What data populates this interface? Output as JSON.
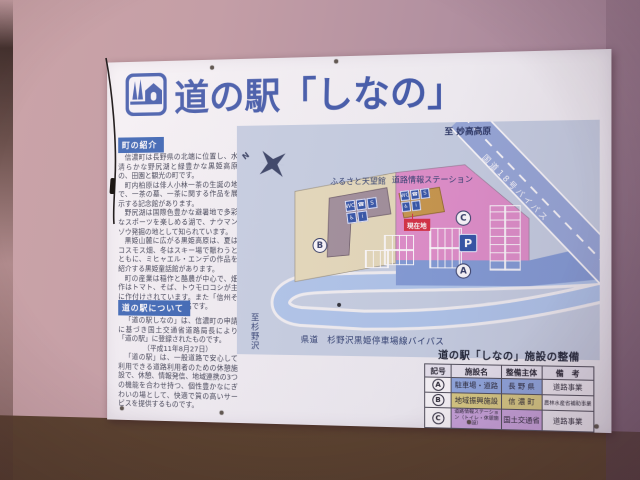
{
  "colors": {
    "accent_blue": "#3a57aa",
    "heading_bar_blue": "#2f5fb2",
    "map_bg": "#c5d0e3",
    "site_beige": "#e6dcba",
    "site_pink": "#e08cc9",
    "front_road_blue": "#7e9ad6",
    "bypass_road_blue": "#93a7d9",
    "loop_road_blue": "#adc6ec",
    "building_b": "#9e8d98",
    "building_c": "#c79544",
    "icon_blue": "#2a4fa5",
    "current_location_red": "#d5283c",
    "table_row_a": "#8ca7e0",
    "table_row_b": "#dacd7e",
    "table_row_c": "#c9a3de",
    "wall_pink": "#c29ca4",
    "wall_brown": "#6e4f3a"
  },
  "sign": {
    "title": "道の駅「しなの」",
    "logo": "michinoeki-pictogram",
    "sections": [
      {
        "heading": "町の紹介",
        "paragraphs": [
          "信濃町は長野県の北端に位置し、水清らかな野尻湖と緑豊かな黒姫高原の、田園と観光の町です。",
          "町内柏原は俳人小林一茶の生誕の地で、一茶の墓、一茶に関する作品を展示する記念館があります。",
          "野尻湖は国際色豊かな避暑地で多彩なスポーツを楽しめる湖で、ナウマンゾウ発掘の地として知られています。",
          "黒姫山麓に広がる黒姫高原は、夏はコスモス畑、冬はスキー場で賑わうとともに、ミヒャエル・エンデの作品を紹介する黒姫童話館があります。",
          "町の産業は稲作と酪農が中心で、畑作はトマト、そば、トウモロコシが主に作付けされています。また「信州そば」の生産地として有名です。"
        ]
      },
      {
        "heading": "道の駅について",
        "paragraphs": [
          "「道の駅しなの」は、信濃町の申請に基づき国土交通省道路局長により「道の駅」に登録されたものです。",
          "（平成11年8月27日）",
          "「道の駅」は、一般道路で安心して利用できる道路利用者のための休憩施設で、休憩、情報発信、地域連携の3つの機能を合わせ持つ、個性豊かなにぎわいの場として、快適で質の高いサービスを提供するものです。"
        ]
      }
    ],
    "map": {
      "north_label": "N",
      "to_myoko": "至 妙高高原",
      "route18_bypass": "国道18号バイパス",
      "furusato_tenbokan": "ふるさと天望館",
      "road_info_station": "道路情報ステーション",
      "current_location": "現在地",
      "parking_symbol": "P",
      "prefroad_bypass": "県道　杉野沢黒姫停車場線バイパス",
      "to_suginosawa": "至杉野沢",
      "markers": {
        "a": "A",
        "b": "B",
        "c": "C"
      },
      "b_building_icons": [
        "WC",
        "☎",
        "S",
        "♿",
        "i"
      ],
      "c_building_icons": [
        "WC",
        "☎",
        "S",
        "♿",
        "i"
      ]
    },
    "table": {
      "title": "道の駅「しなの」施設の整備",
      "headers": [
        "記号",
        "施設名",
        "整備主体",
        "備　考"
      ],
      "rows": [
        {
          "symbol": "A",
          "facility": "駐車場・道路",
          "agency": "長 野 県",
          "note": "道路事業"
        },
        {
          "symbol": "B",
          "facility": "地域振興施設",
          "agency": "信 濃 町",
          "note": "農林水産省補助事業"
        },
        {
          "symbol": "C",
          "facility": "道路情報ステーション（トイレ・休憩施設）",
          "agency": "国土交通省",
          "note": "道路事業"
        }
      ]
    }
  }
}
